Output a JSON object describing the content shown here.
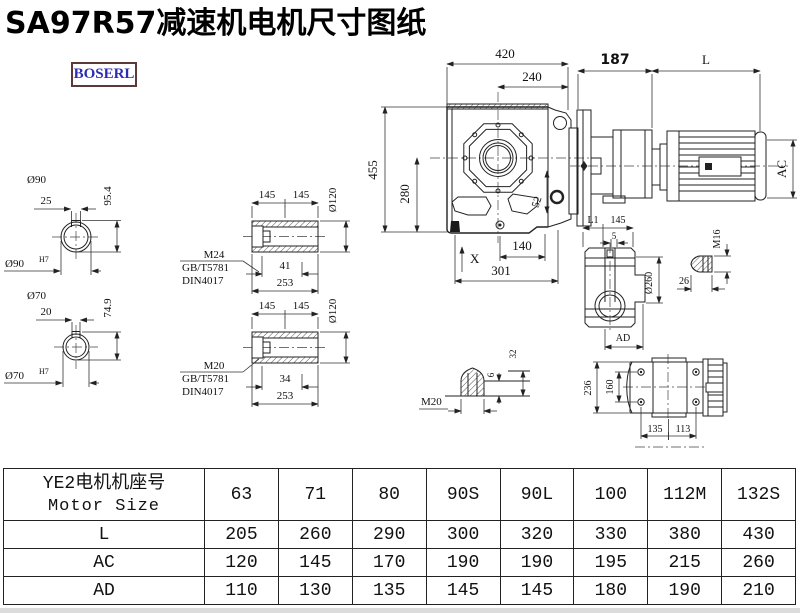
{
  "title": "SA97R57减速机电机尺寸图纸",
  "brand": {
    "name": "BOSERL"
  },
  "colors": {
    "line": "#222222",
    "logo_text": "#2d2db4",
    "logo_border": "#5d3a3a",
    "background": "#ffffff"
  },
  "drawing": {
    "shaft1": {
      "dia": "Ø90",
      "key": "25",
      "height": "95.4",
      "fit": "Ø90",
      "tol": "H7"
    },
    "shaft2": {
      "dia": "Ø70",
      "key": "20",
      "height": "74.9",
      "fit": "Ø70",
      "tol": "H7"
    },
    "hollow1": {
      "len_a": "145",
      "len_b": "145",
      "dia": "Ø120",
      "thread": "M24",
      "std1": "GB/T5781",
      "std2": "DIN4017",
      "depth": "41",
      "total": "253"
    },
    "hollow2": {
      "len_a": "145",
      "len_b": "145",
      "dia": "Ø120",
      "thread": "M20",
      "std1": "GB/T5781",
      "std2": "DIN4017",
      "depth": "34",
      "total": "253"
    },
    "front": {
      "w": "420",
      "wc": "240",
      "h": "455",
      "hi": "280",
      "d52": "52",
      "b1": "140",
      "b2": "301",
      "x": "X"
    },
    "motor": {
      "gear_len": "187",
      "l": "L",
      "ac": "AC"
    },
    "side": {
      "l1": "L1",
      "d145": "145",
      "d5": "5",
      "dia": "Ø260",
      "ad": "AD"
    },
    "stud": {
      "thread": "M16",
      "len": "26"
    },
    "tip": {
      "thread": "M20",
      "d6": "6",
      "d32": "32"
    },
    "top": {
      "h": "236",
      "hi": "160",
      "b1": "135",
      "b2": "113"
    }
  },
  "table": {
    "header": {
      "cn": "YE2电机机座号",
      "en": "Motor Size"
    },
    "sizes": [
      "63",
      "71",
      "80",
      "90S",
      "90L",
      "100",
      "112M",
      "132S"
    ],
    "rows": [
      {
        "label": "L",
        "values": [
          "205",
          "260",
          "290",
          "300",
          "320",
          "330",
          "380",
          "430"
        ]
      },
      {
        "label": "AC",
        "values": [
          "120",
          "145",
          "170",
          "190",
          "190",
          "195",
          "215",
          "260"
        ]
      },
      {
        "label": "AD",
        "values": [
          "110",
          "130",
          "135",
          "145",
          "145",
          "180",
          "190",
          "210"
        ]
      }
    ]
  }
}
